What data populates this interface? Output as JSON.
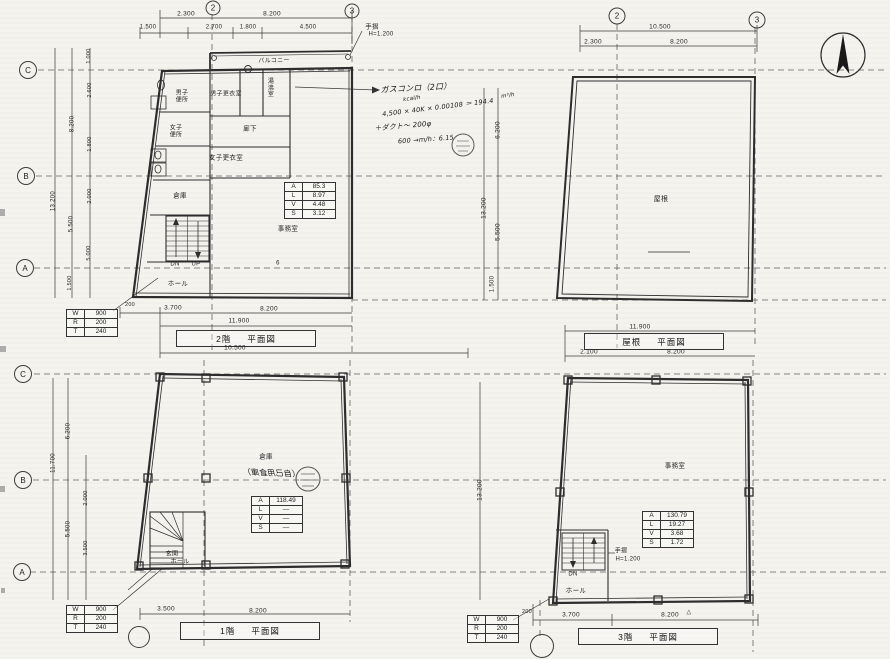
{
  "sheet": {
    "description": "建築平面図（2階・屋根・1階・3階）スキャン図面"
  },
  "titles": {
    "f2": {
      "left": "2階",
      "right": "平面図"
    },
    "roof": {
      "left": "屋根",
      "right": "平面図"
    },
    "f1": {
      "left": "1階",
      "right": "平面図"
    },
    "f3": {
      "left": "3階",
      "right": "平面図"
    }
  },
  "tables": {
    "area_f2": [
      [
        "A",
        "85.3"
      ],
      [
        "L",
        "8.97"
      ],
      [
        "V",
        "4.48"
      ],
      [
        "S",
        "3.12"
      ]
    ],
    "area_f1": [
      [
        "A",
        "118.49"
      ],
      [
        "L",
        "—"
      ],
      [
        "V",
        "—"
      ],
      [
        "S",
        "—"
      ]
    ],
    "area_f3": [
      [
        "A",
        "130.79"
      ],
      [
        "L",
        "19.27"
      ],
      [
        "V",
        "3.68"
      ],
      [
        "S",
        "1.72"
      ]
    ],
    "stair": [
      [
        "W",
        "900"
      ],
      [
        "R",
        "200"
      ],
      [
        "T",
        "240"
      ]
    ]
  },
  "grid_marks": [
    {
      "n": "grid-2-upper-left",
      "label": "2",
      "x": 213,
      "y": 8,
      "d": 15
    },
    {
      "n": "grid-3-upper-left",
      "label": "3",
      "x": 352,
      "y": 11,
      "d": 15
    },
    {
      "n": "grid-2-roof",
      "label": "2",
      "x": 617,
      "y": 16,
      "d": 17
    },
    {
      "n": "grid-3-roof",
      "label": "3",
      "x": 757,
      "y": 20,
      "d": 17
    },
    {
      "n": "grid-c-upper",
      "label": "C",
      "x": 28,
      "y": 70,
      "d": 18
    },
    {
      "n": "grid-b-upper",
      "label": "B",
      "x": 26,
      "y": 176,
      "d": 18
    },
    {
      "n": "grid-a-upper",
      "label": "A",
      "x": 25,
      "y": 268,
      "d": 18
    },
    {
      "n": "grid-c-lower",
      "label": "C",
      "x": 23,
      "y": 374,
      "d": 18
    },
    {
      "n": "grid-b-lower",
      "label": "B",
      "x": 23,
      "y": 480,
      "d": 18
    },
    {
      "n": "grid-a-lower",
      "label": "A",
      "x": 22,
      "y": 572,
      "d": 18
    },
    {
      "n": "grid-mark-f1-bottom",
      "label": "",
      "x": 139,
      "y": 637,
      "d": 22
    },
    {
      "n": "grid-mark-f3-bottom",
      "label": "",
      "x": 542,
      "y": 646,
      "d": 24
    }
  ],
  "labels": [
    {
      "n": "f2-dim-2300",
      "t": "2.300",
      "x": 186,
      "y": 14,
      "fs": 6.5
    },
    {
      "n": "f2-dim-8200-top",
      "t": "8.200",
      "x": 272,
      "y": 14,
      "fs": 6.5
    },
    {
      "n": "f2-dim-1500",
      "t": "1.500",
      "x": 148,
      "y": 28,
      "fs": 6
    },
    {
      "n": "f2-dim-2700",
      "t": "2.700",
      "x": 214,
      "y": 28,
      "fs": 6
    },
    {
      "n": "f2-dim-1800",
      "t": "1.800",
      "x": 248,
      "y": 28,
      "fs": 6
    },
    {
      "n": "f2-dim-4500",
      "t": "4.500",
      "x": 308,
      "y": 28,
      "fs": 6
    },
    {
      "n": "f2-note-handrail",
      "t": "手摺",
      "x": 372,
      "y": 27,
      "fs": 6.5
    },
    {
      "n": "f2-note-handrail-height",
      "t": "H=1.200",
      "x": 381,
      "y": 35,
      "fs": 6
    },
    {
      "n": "f2-balcony-label",
      "t": "バルコニー",
      "x": 274,
      "y": 62,
      "fs": 6
    },
    {
      "n": "f2-room-mens-toilet",
      "t": "男子便所",
      "x": 182,
      "y": 97,
      "fs": 6,
      "w": 15
    },
    {
      "n": "f2-room-mens-locker",
      "t": "男子更衣室",
      "x": 226,
      "y": 95,
      "fs": 6
    },
    {
      "n": "f2-room-boiler",
      "t": "湯沸室",
      "x": 271,
      "y": 89,
      "fs": 6,
      "w": 9
    },
    {
      "n": "f2-room-corridor",
      "t": "廊下",
      "x": 250,
      "y": 129,
      "fs": 6.5
    },
    {
      "n": "f2-room-womens-toilet",
      "t": "女子便所",
      "x": 176,
      "y": 132,
      "fs": 6,
      "w": 15
    },
    {
      "n": "f2-room-womens-locker",
      "t": "女子更衣室",
      "x": 226,
      "y": 158,
      "fs": 6.5
    },
    {
      "n": "f2-room-storage",
      "t": "倉庫",
      "x": 180,
      "y": 196,
      "fs": 6.5
    },
    {
      "n": "f2-room-office",
      "t": "事務室",
      "x": 288,
      "y": 229,
      "fs": 6.5
    },
    {
      "n": "f2-door-number",
      "t": "6",
      "x": 278,
      "y": 264,
      "fs": 6
    },
    {
      "n": "f2-stairs-dn",
      "t": "DN",
      "x": 175,
      "y": 265,
      "fs": 6
    },
    {
      "n": "f2-stairs-up",
      "t": "UP",
      "x": 196,
      "y": 265,
      "fs": 6
    },
    {
      "n": "f2-hall-label",
      "t": "ホール",
      "x": 178,
      "y": 284,
      "fs": 6.5
    },
    {
      "n": "hw-gas-stove",
      "t": "ガスコンロ（2口）",
      "x": 416,
      "y": 89,
      "fs": 8,
      "r": -3,
      "cls": "hw"
    },
    {
      "n": "hw-kcal-unit",
      "t": "kcal/h",
      "x": 412,
      "y": 99,
      "fs": 5.5,
      "r": -8,
      "cls": "hw"
    },
    {
      "n": "hw-vent-calc",
      "t": "4,500 × 40K × 0.00108 ＝ 194.4",
      "x": 438,
      "y": 108,
      "fs": 6.5,
      "r": -7,
      "cls": "hw"
    },
    {
      "n": "hw-m3h-unit",
      "t": "m³/h",
      "x": 508,
      "y": 96,
      "fs": 5.5,
      "r": -8,
      "cls": "hw"
    },
    {
      "n": "hw-duct-note",
      "t": "＋ダクト～ 200φ",
      "x": 403,
      "y": 127,
      "fs": 7,
      "r": -5,
      "cls": "hw"
    },
    {
      "n": "hw-result-note",
      "t": "600 →m/h：6.15",
      "x": 426,
      "y": 140,
      "fs": 6.5,
      "r": -4,
      "cls": "hw"
    },
    {
      "n": "mid-dim-6200",
      "t": "6.200",
      "x": 498,
      "y": 130,
      "fs": 6.5,
      "r": -90
    },
    {
      "n": "mid-dim-13200",
      "t": "13.200",
      "x": 484,
      "y": 208,
      "fs": 6.5,
      "r": -90
    },
    {
      "n": "mid-dim-5500",
      "t": "5.500",
      "x": 498,
      "y": 232,
      "fs": 6.5,
      "r": -90
    },
    {
      "n": "mid-dim-1500",
      "t": "1.500",
      "x": 493,
      "y": 284,
      "fs": 6,
      "r": -90
    },
    {
      "n": "left-dim-1000",
      "t": "1.000",
      "x": 89,
      "y": 56,
      "fs": 5.5,
      "r": -90
    },
    {
      "n": "left-dim-2600",
      "t": "2.600",
      "x": 90,
      "y": 90,
      "fs": 5.5,
      "r": -90
    },
    {
      "n": "left-dim-8200",
      "t": "8.200",
      "x": 73,
      "y": 124,
      "fs": 6,
      "r": -90
    },
    {
      "n": "left-dim-1800",
      "t": "1.800",
      "x": 90,
      "y": 144,
      "fs": 5.5,
      "r": -90
    },
    {
      "n": "left-dim-13200",
      "t": "13.200",
      "x": 54,
      "y": 201,
      "fs": 6,
      "r": -90
    },
    {
      "n": "left-dim-2000",
      "t": "2.000",
      "x": 90,
      "y": 196,
      "fs": 5.5,
      "r": -90
    },
    {
      "n": "left-dim-5500",
      "t": "5.500",
      "x": 72,
      "y": 224,
      "fs": 6,
      "r": -90
    },
    {
      "n": "left-dim-5000",
      "t": "5.000",
      "x": 89,
      "y": 253,
      "fs": 5.5,
      "r": -90
    },
    {
      "n": "left-dim-1500",
      "t": "1.500",
      "x": 70,
      "y": 283,
      "fs": 5.5,
      "r": -90
    },
    {
      "n": "f2-dim-200",
      "t": "200",
      "x": 130,
      "y": 305,
      "fs": 5.5
    },
    {
      "n": "f2-dim-3700",
      "t": "3.700",
      "x": 173,
      "y": 308,
      "fs": 6.5
    },
    {
      "n": "f2-dim-8200-bot",
      "t": "8.200",
      "x": 269,
      "y": 309,
      "fs": 6.5
    },
    {
      "n": "f2-dim-11900",
      "t": "11.900",
      "x": 239,
      "y": 321,
      "fs": 6.5
    },
    {
      "n": "f2-dim-10500",
      "t": "10.500",
      "x": 235,
      "y": 348,
      "fs": 6.5
    },
    {
      "n": "roof-dim-10500",
      "t": "10.500",
      "x": 660,
      "y": 27,
      "fs": 6.5
    },
    {
      "n": "roof-dim-2300",
      "t": "2.300",
      "x": 593,
      "y": 42,
      "fs": 6.5
    },
    {
      "n": "roof-dim-8200-top",
      "t": "8.200",
      "x": 679,
      "y": 42,
      "fs": 6.5
    },
    {
      "n": "roof-label",
      "t": "屋根",
      "x": 661,
      "y": 200,
      "fs": 7
    },
    {
      "n": "roof-dim-11900",
      "t": "11.900",
      "x": 640,
      "y": 327,
      "fs": 6.5
    },
    {
      "n": "roof-dim-2100",
      "t": "2.100",
      "x": 589,
      "y": 352,
      "fs": 6.5
    },
    {
      "n": "roof-dim-8200-bot",
      "t": "8.200",
      "x": 676,
      "y": 352,
      "fs": 6.5
    },
    {
      "n": "f1-left-dim-6200",
      "t": "6.200",
      "x": 69,
      "y": 431,
      "fs": 6,
      "r": -90
    },
    {
      "n": "f1-left-dim-11700",
      "t": "11.700",
      "x": 54,
      "y": 463,
      "fs": 6,
      "r": -90
    },
    {
      "n": "f1-left-dim-2000",
      "t": "2.000",
      "x": 86,
      "y": 498,
      "fs": 5.5,
      "r": -90
    },
    {
      "n": "f1-left-dim-5500",
      "t": "5.500",
      "x": 69,
      "y": 529,
      "fs": 6,
      "r": -90
    },
    {
      "n": "f1-left-dim-3500",
      "t": "3.500",
      "x": 86,
      "y": 548,
      "fs": 5.5,
      "r": -90
    },
    {
      "n": "f1-room-storage",
      "t": "倉庫",
      "x": 266,
      "y": 457,
      "fs": 6.5
    },
    {
      "n": "f1-bleedthrough-note",
      "t": "（自己用倉庫）",
      "x": 272,
      "y": 474,
      "fs": 8,
      "r": 2,
      "mir": true,
      "cls": "hw"
    },
    {
      "n": "f1-entrance",
      "t": "玄関",
      "x": 172,
      "y": 555,
      "fs": 6
    },
    {
      "n": "f1-hall-label",
      "t": "ホール",
      "x": 180,
      "y": 563,
      "fs": 6
    },
    {
      "n": "f1-dim-3500",
      "t": "3.500",
      "x": 166,
      "y": 609,
      "fs": 6.5
    },
    {
      "n": "f1-dim-8200",
      "t": "8.200",
      "x": 258,
      "y": 611,
      "fs": 6.5
    },
    {
      "n": "f3-room-office",
      "t": "事務室",
      "x": 675,
      "y": 466,
      "fs": 6.5
    },
    {
      "n": "f3-stairs-dn",
      "t": "DN",
      "x": 573,
      "y": 575,
      "fs": 6
    },
    {
      "n": "f3-note-handrail",
      "t": "手摺",
      "x": 621,
      "y": 552,
      "fs": 6
    },
    {
      "n": "f3-note-handrail-height",
      "t": "H=1.200",
      "x": 628,
      "y": 560,
      "fs": 6
    },
    {
      "n": "f3-hall-label",
      "t": "ホール",
      "x": 576,
      "y": 591,
      "fs": 6.5
    },
    {
      "n": "f3-dim-200",
      "t": "200",
      "x": 527,
      "y": 612,
      "fs": 5.5
    },
    {
      "n": "f3-dim-3700",
      "t": "3.700",
      "x": 571,
      "y": 615,
      "fs": 6.5
    },
    {
      "n": "f3-dim-8200",
      "t": "8.200",
      "x": 670,
      "y": 615,
      "fs": 6.5
    },
    {
      "n": "f3-triangle-mark",
      "t": "△",
      "x": 689,
      "y": 613,
      "fs": 6
    },
    {
      "n": "mid-dim-13200-lower",
      "t": "13.200",
      "x": 480,
      "y": 490,
      "fs": 6.5,
      "r": -90
    }
  ]
}
